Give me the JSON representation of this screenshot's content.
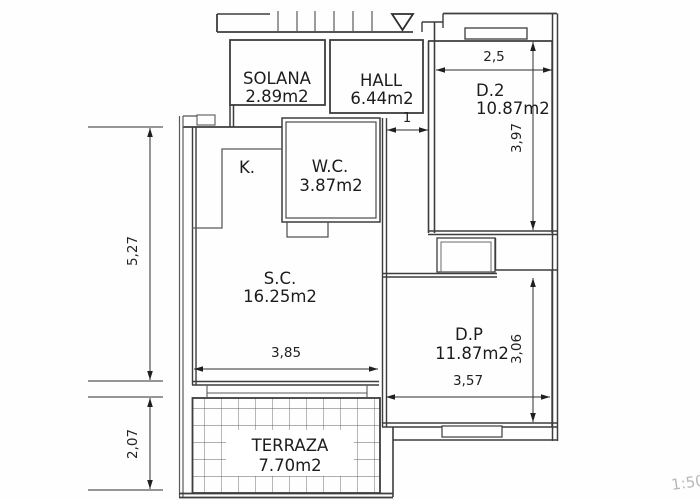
{
  "plan": {
    "title": "apartment-floor-plan",
    "scale_note": "1:50",
    "rooms": {
      "solana": {
        "name": "SOLANA",
        "area": "2.89m2"
      },
      "hall": {
        "name": "HALL",
        "area": "6.44m2"
      },
      "d2": {
        "name": "D.2",
        "area": "10.87m2"
      },
      "wc": {
        "name": "W.C.",
        "area": "3.87m2"
      },
      "kitchen": {
        "name": "K."
      },
      "sc": {
        "name": "S.C.",
        "area": "16.25m2"
      },
      "dp": {
        "name": "D.P",
        "area": "11.87m2"
      },
      "terraza": {
        "name": "TERRAZA",
        "area": "7.70m2"
      }
    },
    "dimensions": {
      "d2_width": "2,5",
      "d2_depth": "3,97",
      "hall_door": "1",
      "left_upper": "5,27",
      "left_lower": "2,07",
      "sc_width": "3,85",
      "dp_width": "3,57",
      "dp_depth": "3,06"
    },
    "colors": {
      "wall": "#3d3d3d",
      "dimension": "#222222",
      "scale_note": "#b8b8b8",
      "paper": "#fefefe"
    }
  }
}
